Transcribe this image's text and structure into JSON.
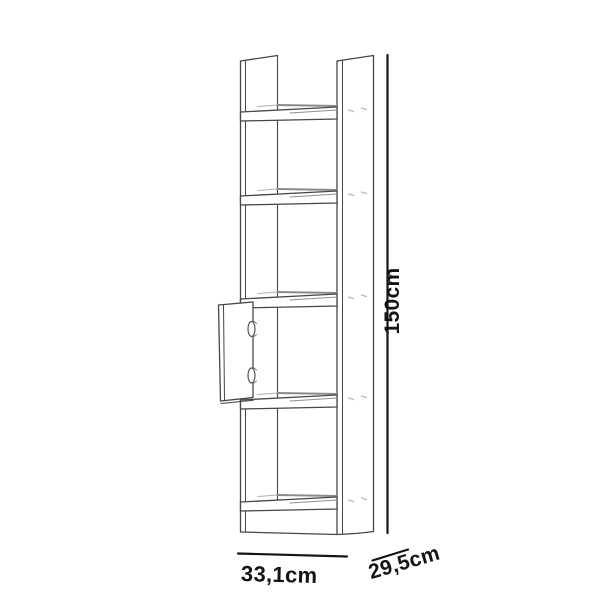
{
  "diagram": {
    "kind": "furniture dimension line drawing",
    "item": "tall narrow bookcase with five shelves and a small cabinet door",
    "background_color": "#ffffff",
    "outline_color": "#474747",
    "shelf_edge_color": "#8a8a8a",
    "hardware_mark_color": "#b8b8b8",
    "dimension_color": "#141414",
    "labels": {
      "height": "150cm",
      "width": "33,1cm",
      "depth": "29,5cm"
    },
    "shelf_count": 5,
    "hinge_count": 2
  }
}
